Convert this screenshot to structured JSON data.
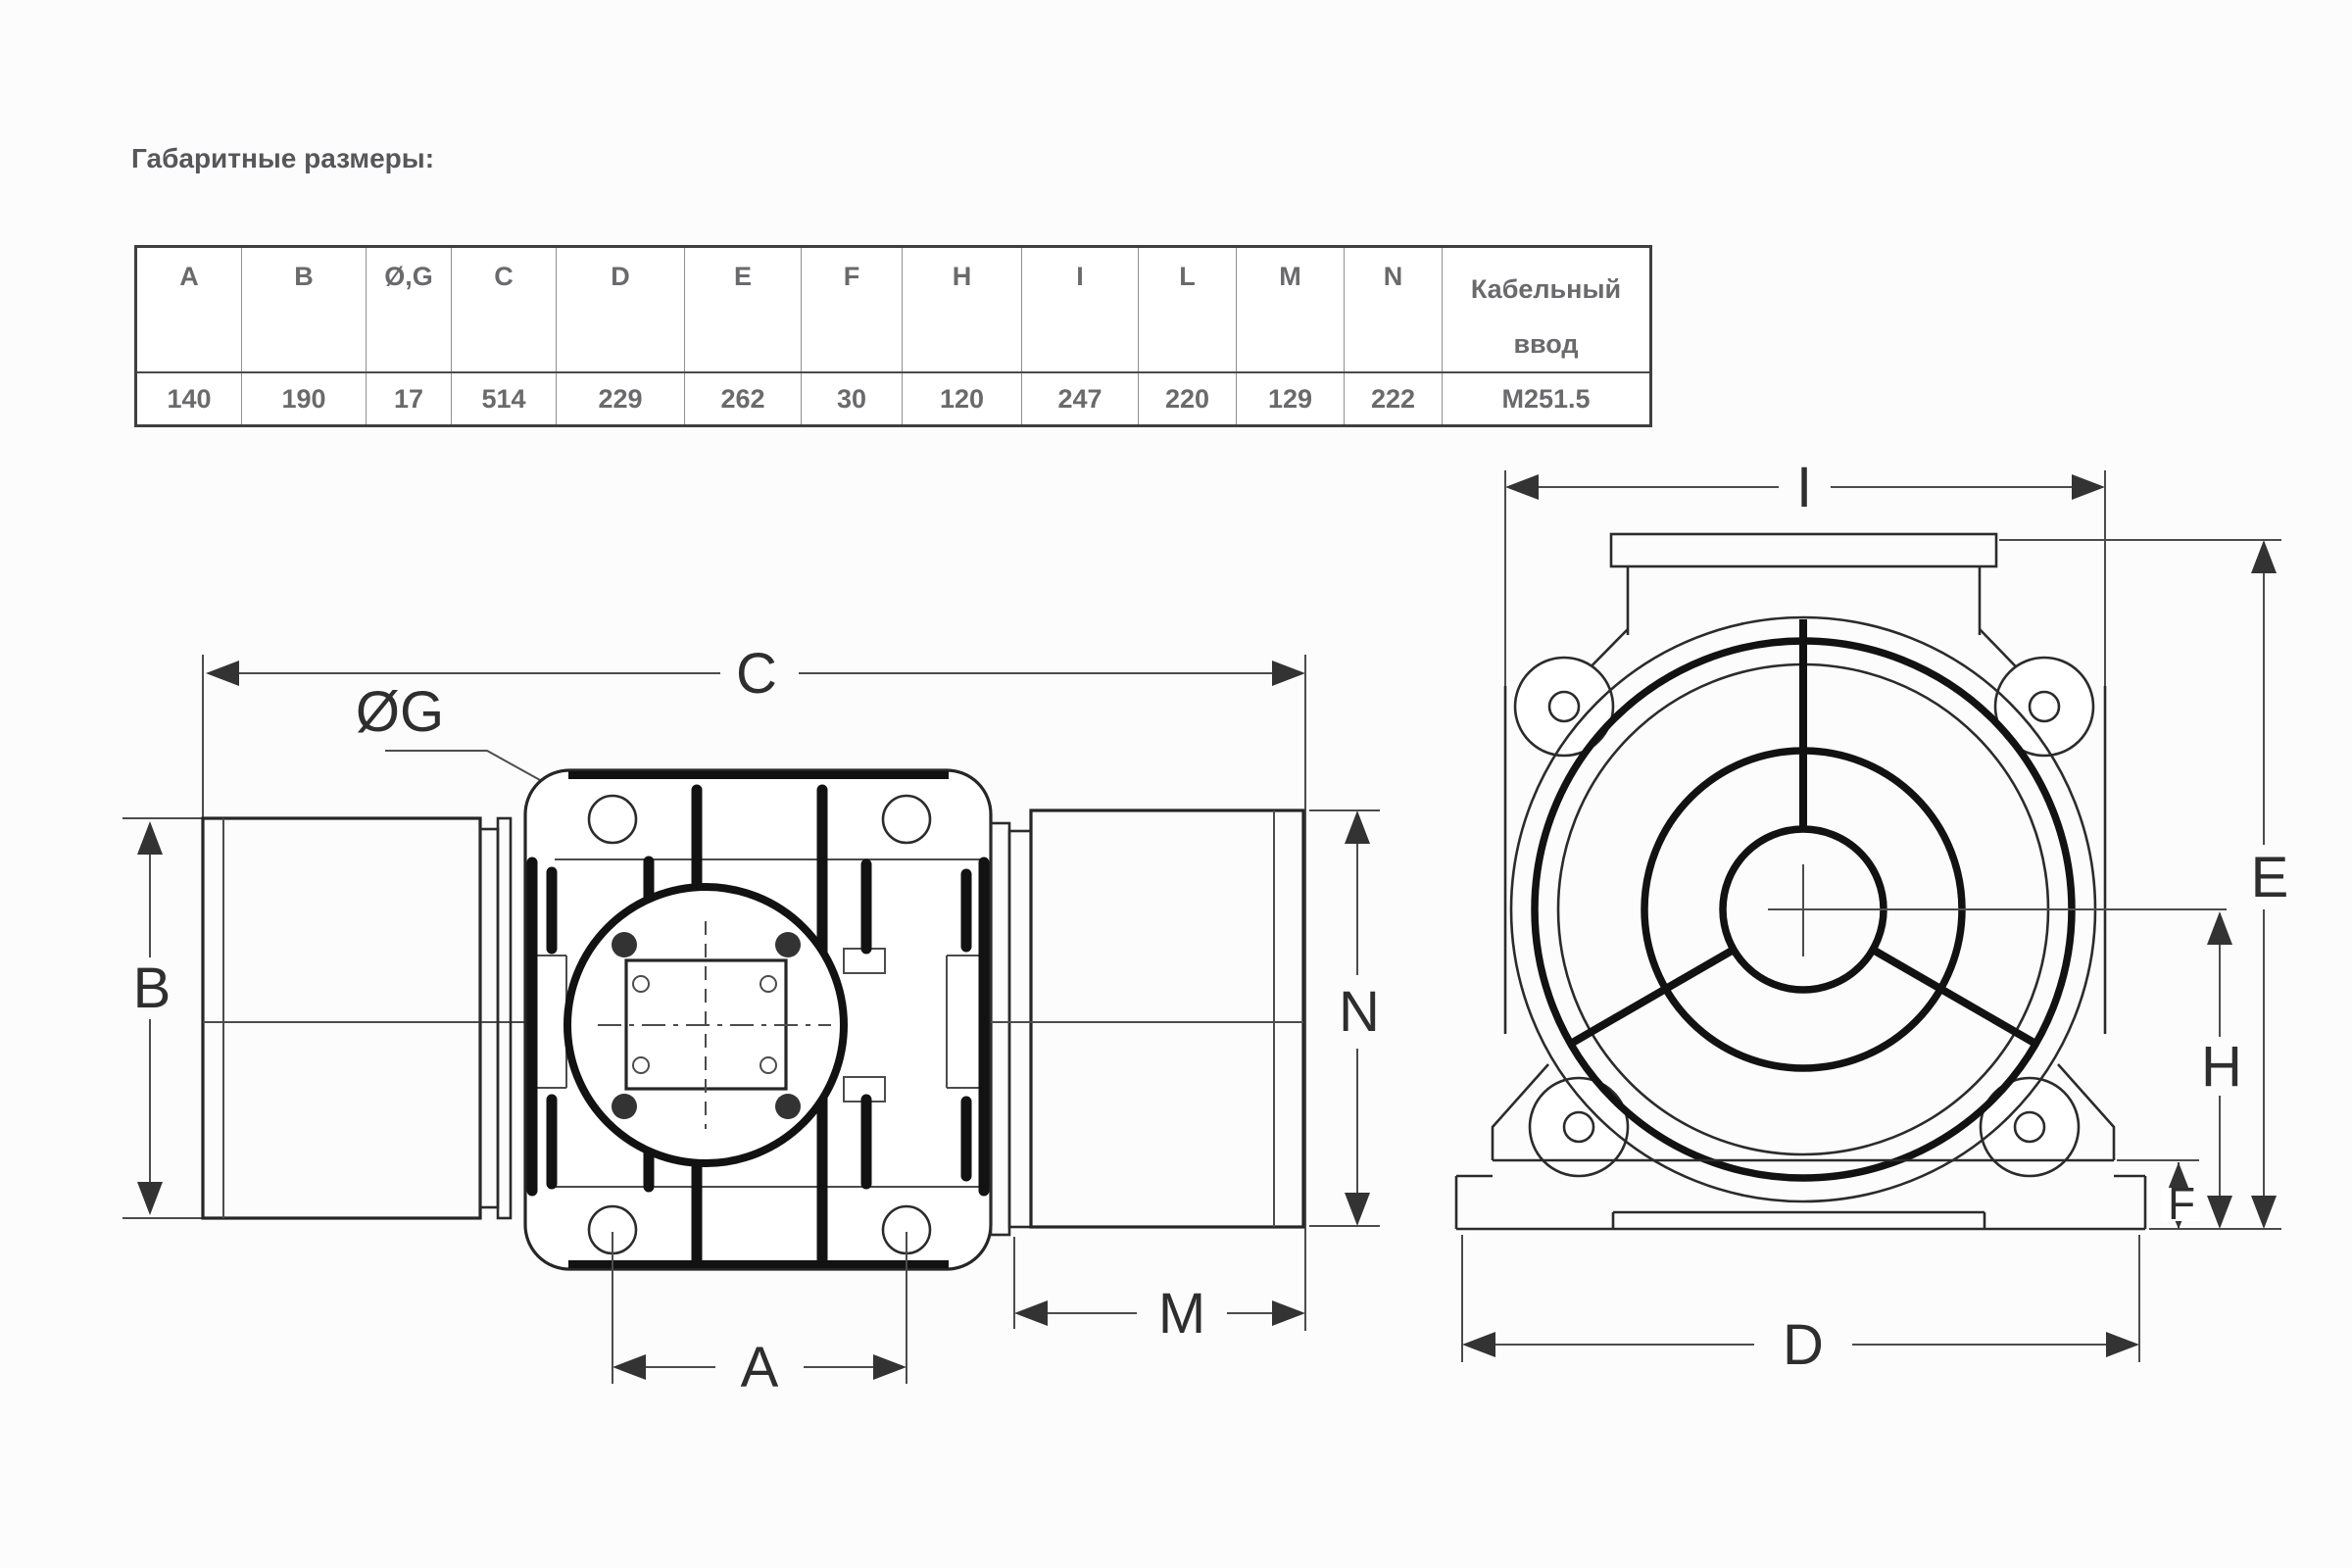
{
  "page": {
    "title": "Габаритные размеры:"
  },
  "table": {
    "headers": [
      "A",
      "B",
      "Ø,G",
      "C",
      "D",
      "E",
      "F",
      "H",
      "I",
      "L",
      "M",
      "N",
      "Кабельный ввод"
    ],
    "values": [
      "140",
      "190",
      "17",
      "514",
      "229",
      "262",
      "30",
      "120",
      "247",
      "220",
      "129",
      "222",
      "M251.5"
    ]
  },
  "drawings": {
    "side_view": {
      "dims": {
        "c": "C",
        "og": "ØG",
        "b": "B",
        "n": "N",
        "m": "M",
        "a": "A"
      }
    },
    "front_view": {
      "dims": {
        "i": "I",
        "e": "E",
        "h": "H",
        "f": "F",
        "d": "D"
      }
    }
  },
  "colors": {
    "text_gray": "#6a6a6d",
    "line_dark": "#262626"
  }
}
